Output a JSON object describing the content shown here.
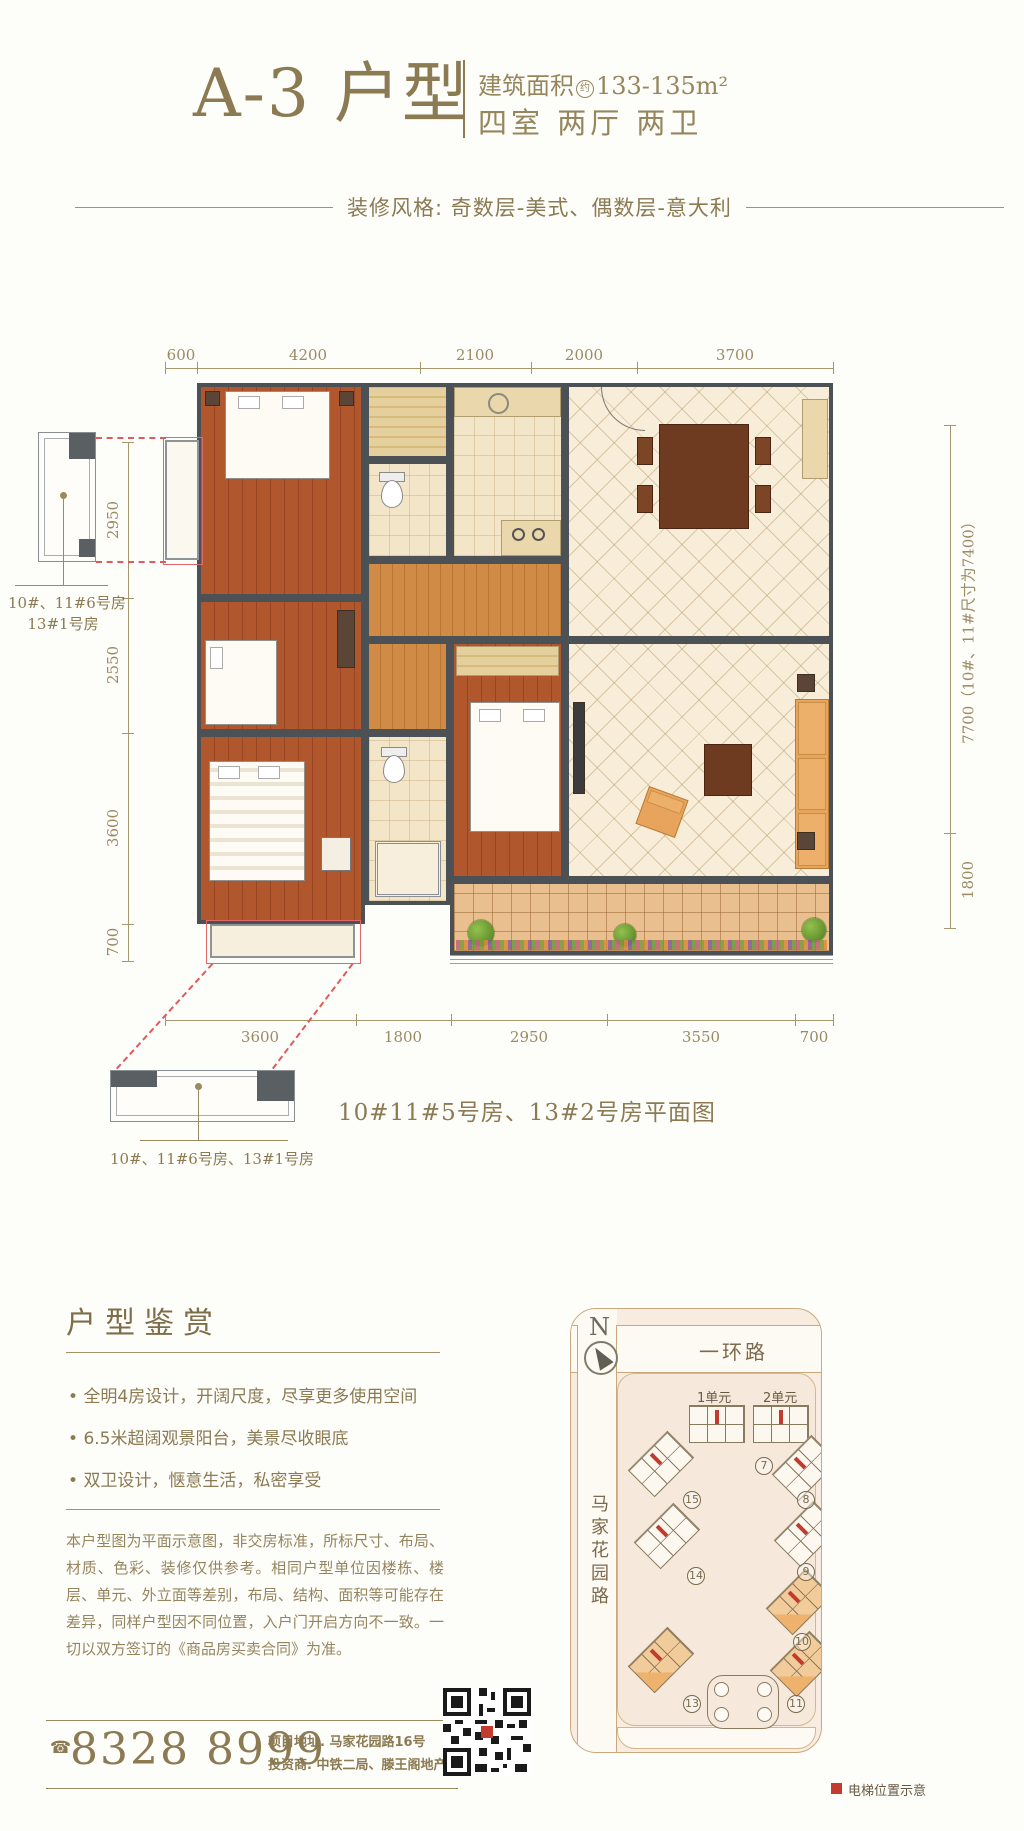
{
  "header": {
    "title": "A-3 户型",
    "area_label": "建筑面积",
    "area_approx": "约",
    "area_value": "133-135m²",
    "rooms_line": "四室 两厅 两卫",
    "style_line": "装修风格: 奇数层-美式、偶数层-意大利"
  },
  "floorplan": {
    "dims_top": [
      "600",
      "4200",
      "2100",
      "2000",
      "3700"
    ],
    "dims_left": [
      "2950",
      "2550",
      "3600",
      "700"
    ],
    "dims_right": [
      "7700（10#、11#尺寸为7400）",
      "1800"
    ],
    "dims_bottom": [
      "3600",
      "1800",
      "2950",
      "3550",
      "700"
    ],
    "detail_label_left_line1": "10#、11#6号房",
    "detail_label_left_line2": "13#1号房",
    "detail_label_bottom": "10#、11#6号房、13#1号房",
    "caption": "10#11#5号房、13#2号房平面图"
  },
  "appreciation": {
    "heading": "户型鉴赏",
    "bullets": [
      "全明4房设计，开阔尺度，尽享更多使用空间",
      "6.5米超阔观景阳台，美景尽收眼底",
      "双卫设计，惬意生活，私密享受"
    ],
    "disclaimer": "本户型图为平面示意图，非交房标准，所标尺寸、布局、材质、色彩、装修仅供参考。相同户型单位因楼栋、楼层、单元、外立面等差别，布局、结构、面积等可能存在差异，同样户型因不同位置，入户门开启方向不一致。一切以双方签订的《商品房买卖合同》为准。"
  },
  "contact": {
    "phone_icon": "☎",
    "phone": "8328 8999",
    "address_line1": "项目地址. 马家花园路16号",
    "address_line2": "投资商. 中铁二局、滕王阁地产"
  },
  "sitemap": {
    "north_label": "N",
    "road_top": "一环路",
    "road_left": "马家花园路",
    "unit1": "1单元",
    "unit2": "2单元",
    "buildings": [
      "7",
      "15",
      "8",
      "14",
      "9",
      "10",
      "13",
      "11"
    ],
    "legend": "电梯位置示意"
  },
  "colors": {
    "gold": "#8b7a52",
    "wall": "#4c5156",
    "wood_floor": "#b0572d",
    "tile_cream": "#f3e6c8",
    "terrace": "#eabf90",
    "red_accent": "#c23b2e",
    "map_bg": "#f8ece1"
  }
}
